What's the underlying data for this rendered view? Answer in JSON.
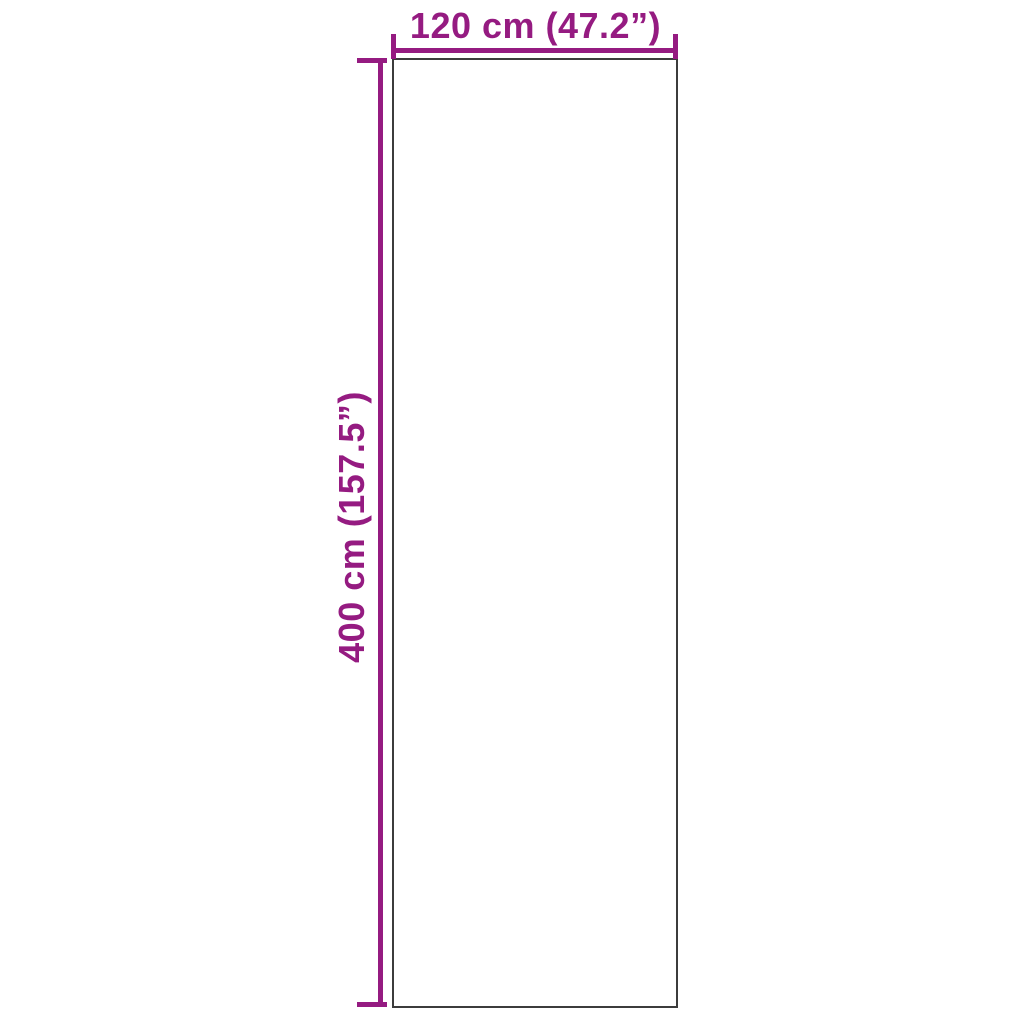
{
  "diagram": {
    "type": "product-dimension-diagram",
    "width": {
      "label": "120 cm (47.2”)",
      "cm": 120,
      "inches": 47.2
    },
    "height": {
      "label": "400 cm (157.5”)",
      "cm": 400,
      "inches": 157.5
    },
    "colors": {
      "accent": "#951b81",
      "outline": "#3c3c3c",
      "background": "#ffffff"
    }
  }
}
